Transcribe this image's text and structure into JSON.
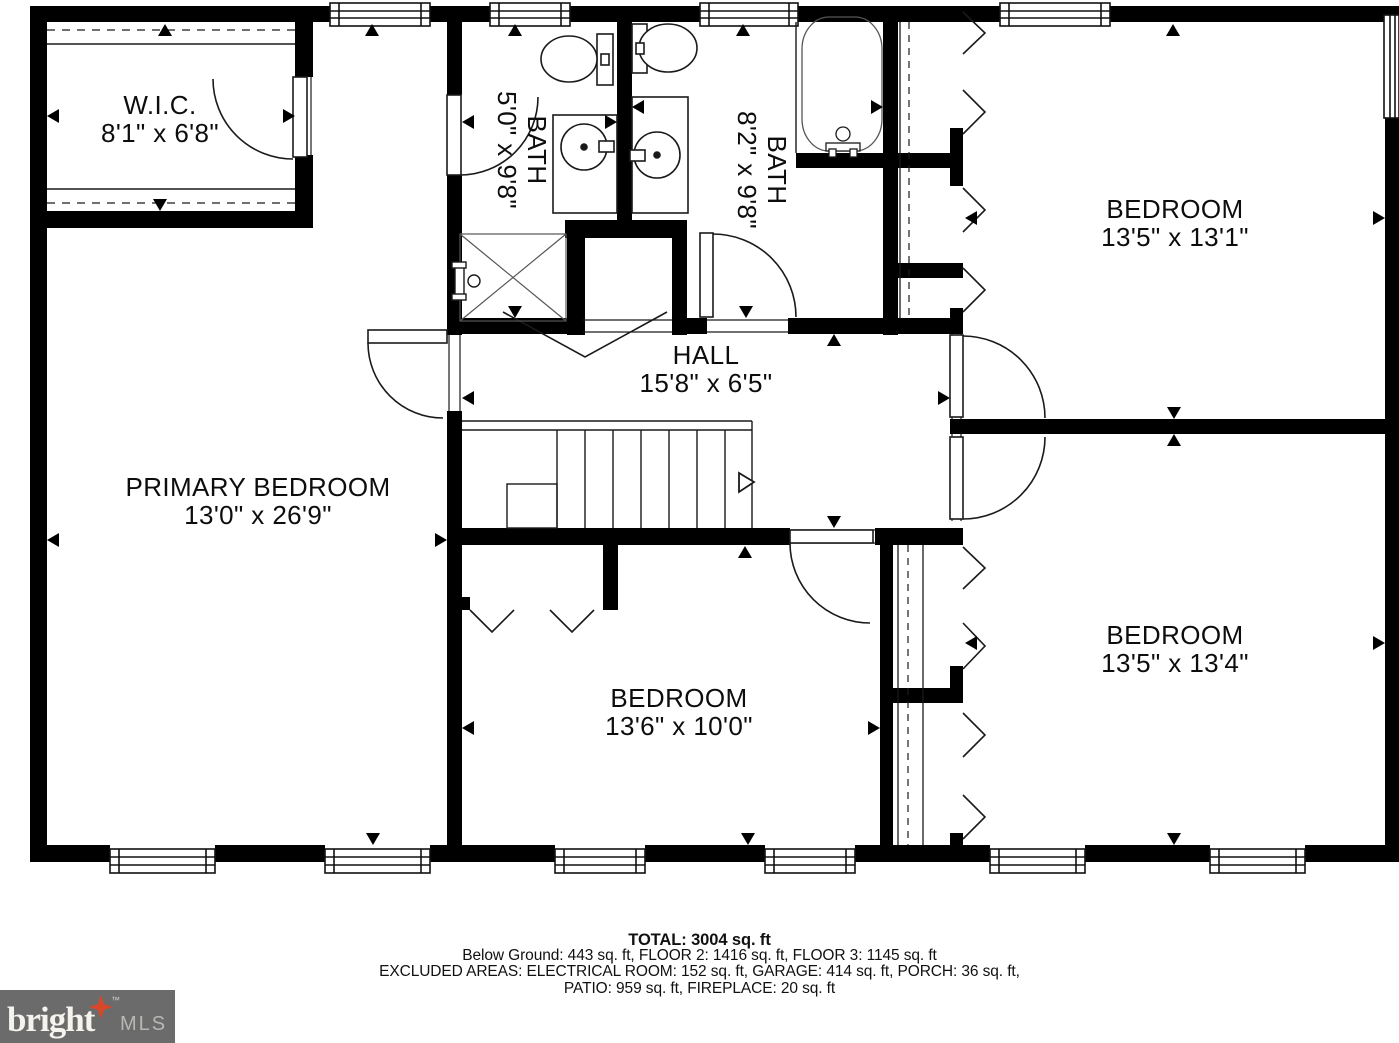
{
  "rooms": [
    {
      "name": "W.I.C.",
      "dims": "8'1\" x 6'8\""
    },
    {
      "name": "BATH",
      "dims": "5'0\" x 9'8\""
    },
    {
      "name": "BATH",
      "dims": "8'2\" x 9'8\""
    },
    {
      "name": "BEDROOM",
      "dims": "13'5\" x 13'1\""
    },
    {
      "name": "HALL",
      "dims": "15'8\" x 6'5\""
    },
    {
      "name": "PRIMARY BEDROOM",
      "dims": "13'0\" x 26'9\""
    },
    {
      "name": "BEDROOM",
      "dims": "13'6\" x 10'0\""
    },
    {
      "name": "BEDROOM",
      "dims": "13'5\" x 13'4\""
    }
  ],
  "summary": {
    "total": "TOTAL: 3004 sq. ft",
    "floors": "Below Ground: 443 sq. ft, FLOOR 2: 1416 sq. ft, FLOOR 3: 1145 sq. ft",
    "excluded1": "EXCLUDED AREAS: ELECTRICAL ROOM: 152 sq. ft, GARAGE: 414 sq. ft, PORCH: 36 sq. ft,",
    "excluded2": "PATIO: 959 sq. ft, FIREPLACE: 20 sq. ft"
  },
  "logo": {
    "brand": "bright",
    "tm": "™",
    "suffix": "MLS",
    "bg_color": "#6b6b6b",
    "brand_color": "#f5f3ee",
    "suffix_color": "#b9b7b3",
    "star_color": "#d9472b"
  },
  "colors": {
    "wall": "#000000",
    "line": "#1a1a1a",
    "paper": "#ffffff"
  }
}
